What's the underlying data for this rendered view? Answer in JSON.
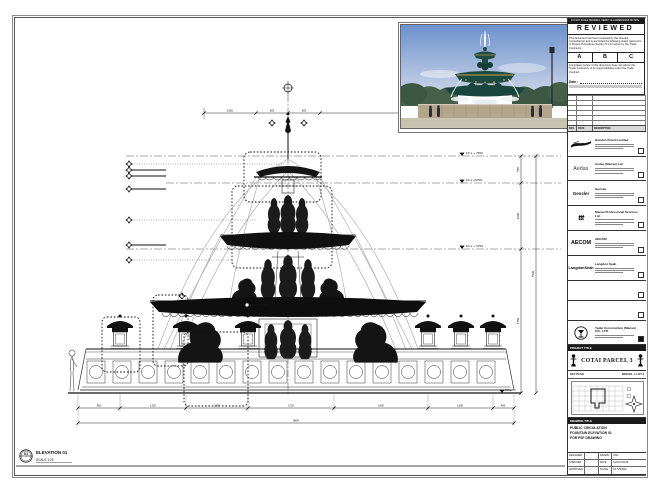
{
  "stamp": {
    "top_bar": "DO NOT SCALE DRAWING. VERIFY ALL DIMENSIONS ON SITE.",
    "title": "REVIEWED",
    "body1": "This document has been reviewed by the relevant Consultant(s) and is accorded the following status referred to in Project Procedures Section 5.4 for action by the Trade Contractor.",
    "status_options": [
      "A",
      "B",
      "C"
    ],
    "body2": "Consultant review of this document does not relieve the Trade Contractor of its responsibilities under the Trade Contract.",
    "date_label": "Date :"
  },
  "revision_table": {
    "rev": "REV.",
    "date": "DATE",
    "description": "DESCRIPTION"
  },
  "consultants": [
    {
      "logo": "",
      "name": "Handon Orient Limited"
    },
    {
      "logo": "Aedas",
      "name": "Aedas (Macau) Ltd."
    },
    {
      "logo": "Gensler",
      "name": "Gensler"
    },
    {
      "logo": "ttt",
      "name": "Macau Professional Services Ltd."
    },
    {
      "logo": "AECOM",
      "name": "AECOM"
    },
    {
      "logo": "LangdonSeah",
      "name": "Langdon Seah"
    }
  ],
  "contractor": {
    "name": "Yadie Construction (Macau) CO., LTD."
  },
  "project": {
    "header": "PROJECT TITLE",
    "name": "COTAI PARCEL 3"
  },
  "key_plan": {
    "header": "KEY PLAN",
    "note": "PARCEL 1, LOT 3"
  },
  "drawing_title": {
    "header": "DRAWING TITLE",
    "line1": "PUBLIC CIRCULATION",
    "line2": "FOUNTAIN ELEVATION 01",
    "line3": "FOR FSF DRAWING"
  },
  "info": {
    "designed_label": "DESIGNED",
    "designed": "-",
    "drawn_label": "DRAWN",
    "drawn": "CAD",
    "checked_label": "CHECKED",
    "checked": "-",
    "date_label": "DATE",
    "date": "12/AUG/2016",
    "approved_label": "APPROVED",
    "approved": "-",
    "scale_label": "SCALE",
    "scale": "AS SHOWN",
    "dwg_label": "DWG NO.",
    "dwg_no": "P3-GA_FD_JW-001",
    "rev_label": "REV.",
    "rev": "B",
    "job_label": "JOB NUMBER",
    "job_no": "31010",
    "cad_label": "CAD FILE NAME",
    "cad_file": "P3-GA_FD_JW-001.dwg"
  },
  "drawing": {
    "elevation_label": "ELEVATION 01",
    "scale_label": "SCALE 1:25",
    "bubble_number": "01",
    "levels": [
      "F.F.L + 7500",
      "F.F.L +6750",
      "F.F.L + 4750",
      "F.F.L ±0"
    ],
    "right_dims": [
      "750",
      "2000",
      "4750",
      "7500"
    ],
    "top_dims": [
      "1850",
      "650",
      "650",
      "1850"
    ],
    "bottom_dims": [
      "850",
      "1325",
      "1250",
      "1725",
      "1900",
      "1300",
      "450"
    ],
    "bottom_total": "8800"
  }
}
